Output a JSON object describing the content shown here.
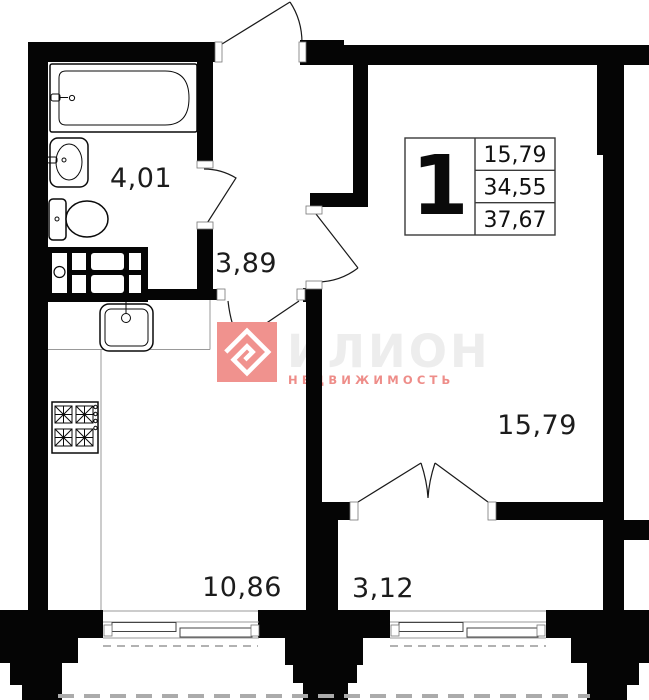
{
  "plan": {
    "unit_number": "1",
    "info_box": {
      "rows": [
        "15,79",
        "34,55",
        "37,67"
      ]
    },
    "rooms": {
      "bathroom": {
        "area": "4,01"
      },
      "hallway": {
        "area": "3,89"
      },
      "living": {
        "area": "15,79"
      },
      "kitchen": {
        "area": "10,86"
      },
      "balcony": {
        "area": "3,12"
      }
    },
    "watermark": {
      "brand": "ИЛИОН",
      "subtitle": "НЕДВИЖИМОСТЬ",
      "brand_color": "#ee8d89",
      "faded_text_color": "#ededed",
      "logo_bg_color": "#f0928e"
    }
  }
}
